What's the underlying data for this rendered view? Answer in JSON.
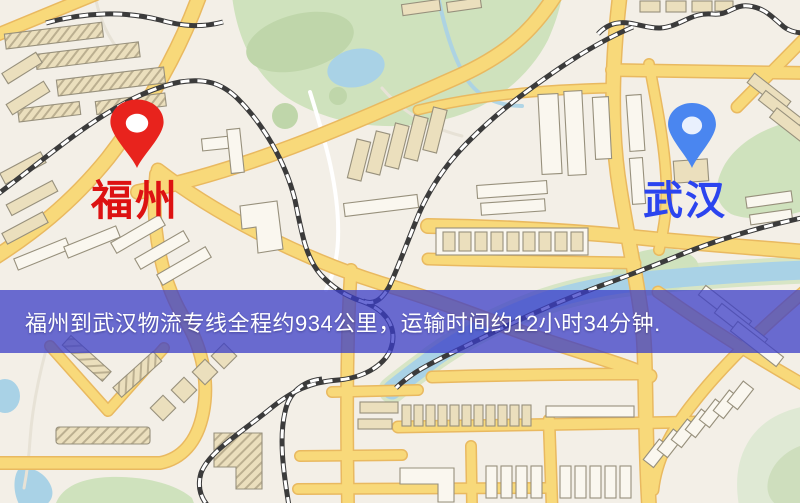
{
  "banner": {
    "text": "福州到武汉物流专线全程约934公里，运输时间约12小时34分钟.",
    "bg": "rgba(59,61,199,0.75)",
    "text_color": "#ffffff"
  },
  "markers": {
    "origin": {
      "label": "福州",
      "label_color": "#dd1212",
      "pin_color": "#e8231d"
    },
    "destination": {
      "label": "武汉",
      "label_color": "#2b44ef",
      "pin_color": "#4a86f0"
    }
  },
  "map_colors": {
    "background": "#f3efe7",
    "road_fill": "#f8d97a",
    "road_casing": "#e9b960",
    "minor_road": "#ffffff",
    "park": "#cfe2bd",
    "park_dark": "#bfd6aa",
    "hill_green": "#dfe9d4",
    "water": "#a9d2e6",
    "railway_dark": "#3b3b3b",
    "railway_light": "#ffffff",
    "building_tan": "#ebdfbd",
    "building_light": "#faf7ef",
    "building_outline": "#97907c"
  }
}
